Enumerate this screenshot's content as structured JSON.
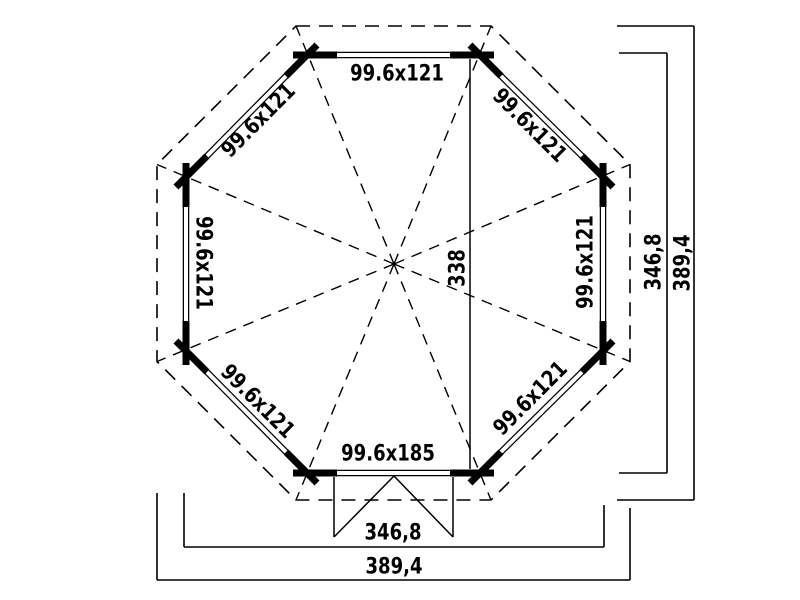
{
  "document": {
    "type": "floor-plan-drawing",
    "subject": "octagonal gazebo plan view with roof overhang and entrance steps"
  },
  "colors": {
    "ink": "#000000",
    "paper": "#ffffff"
  },
  "walls": {
    "top_label": "99.6x121",
    "north_west_label": "99.6x121",
    "north_east_label": "99.6x121",
    "west_label": "99.6x121",
    "east_label": "99.6x121",
    "south_west_label": "99.6x121",
    "south_east_label": "99.6x121",
    "front_label": "99.6x185"
  },
  "dimensions": {
    "inner_span": "338",
    "right_wall_width": "346,8",
    "right_roof_width": "389,4",
    "bottom_wall_width": "346,8",
    "bottom_roof_width": "389,4"
  }
}
